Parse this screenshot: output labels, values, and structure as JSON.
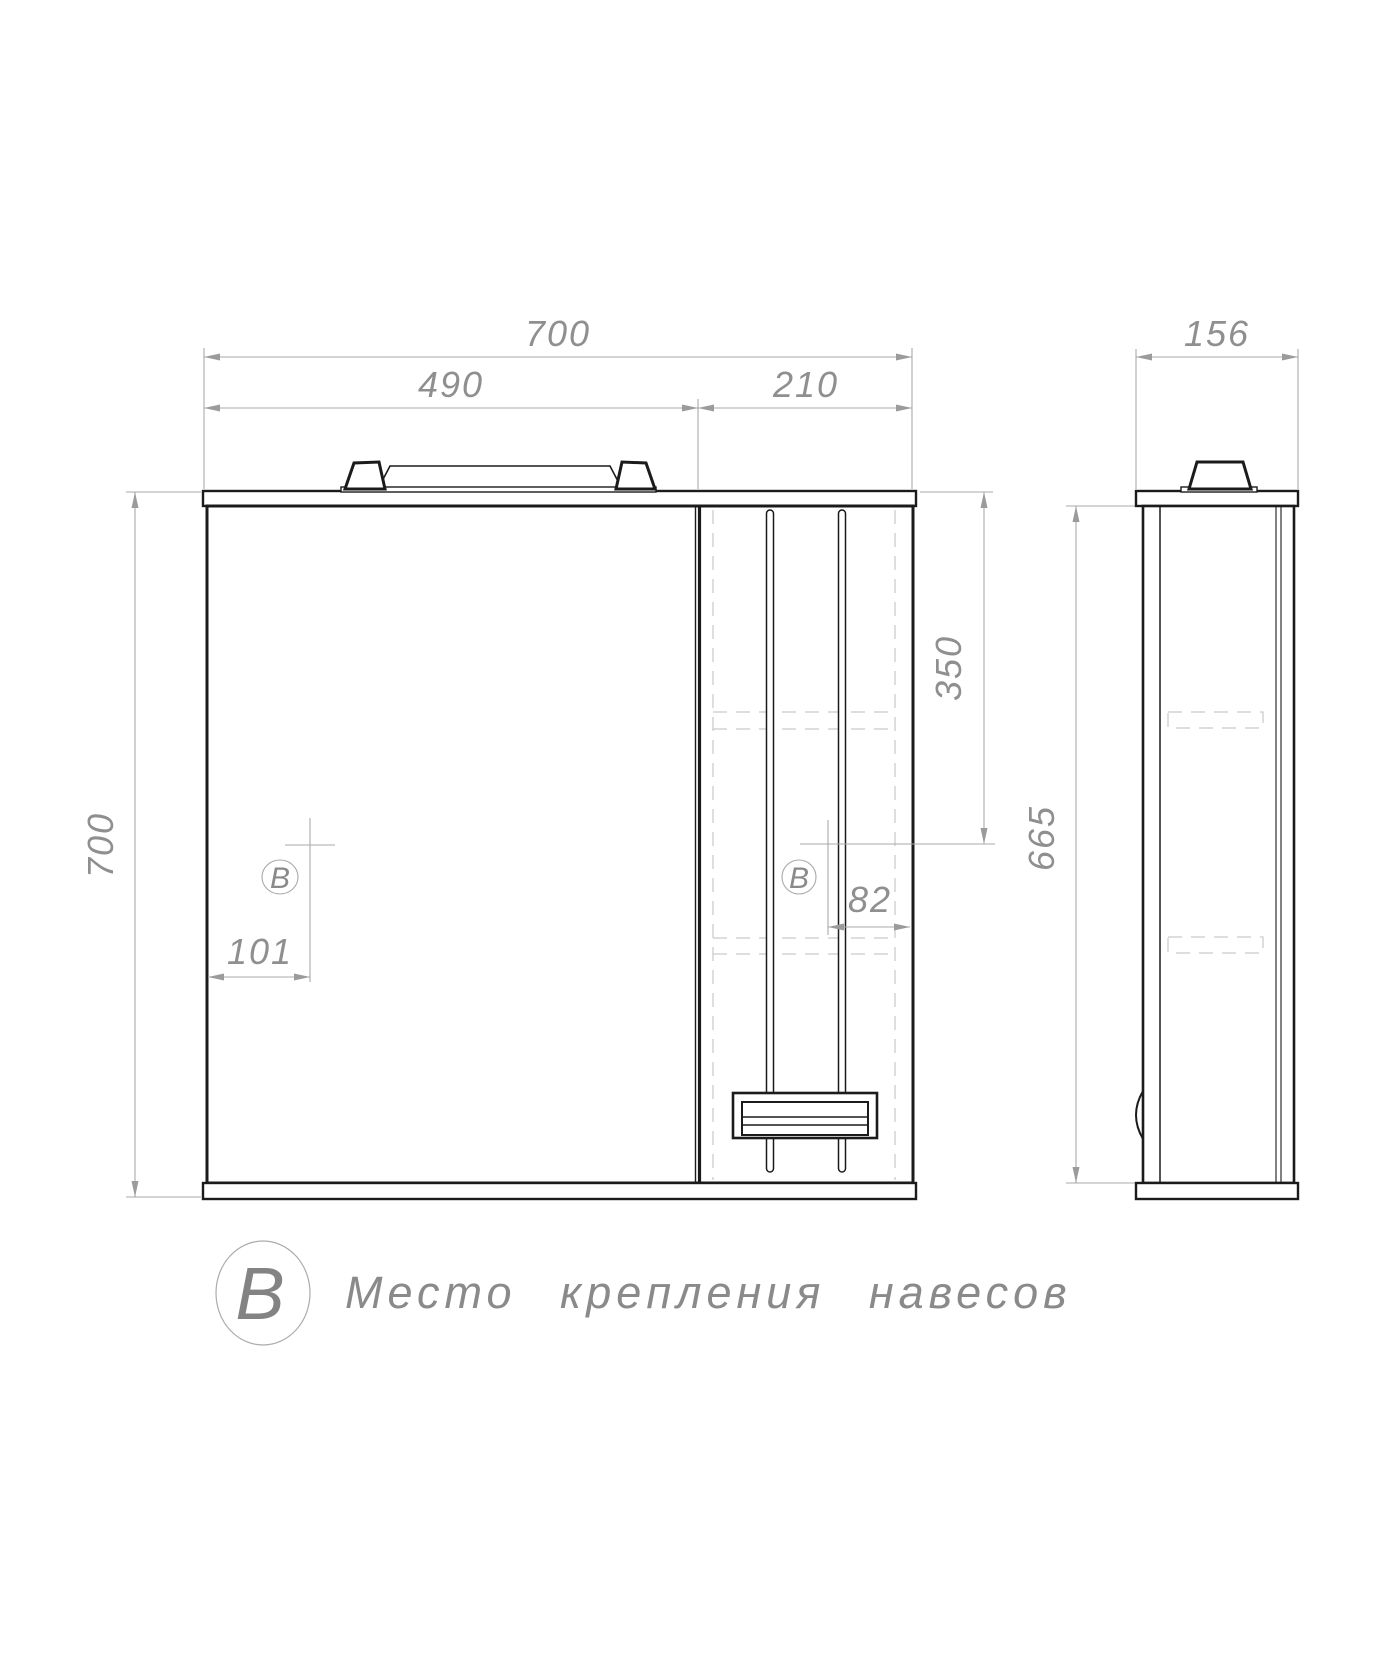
{
  "drawing": {
    "type": "furniture technical drawing",
    "subject": "mirror cabinet with light, front and side views"
  },
  "colors": {
    "background": "#ffffff",
    "object_line": "#1b1b1b",
    "dimension_line": "#a9a9a9",
    "dimension_text": "#8f8f8f",
    "hidden_line": "#c9c9c9"
  },
  "dims": {
    "front_width": "700",
    "mirror_width": "490",
    "door_width": "210",
    "front_height": "700",
    "hinge_from_top": "350",
    "hinge_from_edge": "82",
    "mirror_hinge_offset": "101",
    "side_depth": "156",
    "side_height": "665"
  },
  "markers": {
    "mirror": "B",
    "door": "B"
  },
  "legend": {
    "symbol": "B",
    "text": "Место крепления навесов"
  }
}
